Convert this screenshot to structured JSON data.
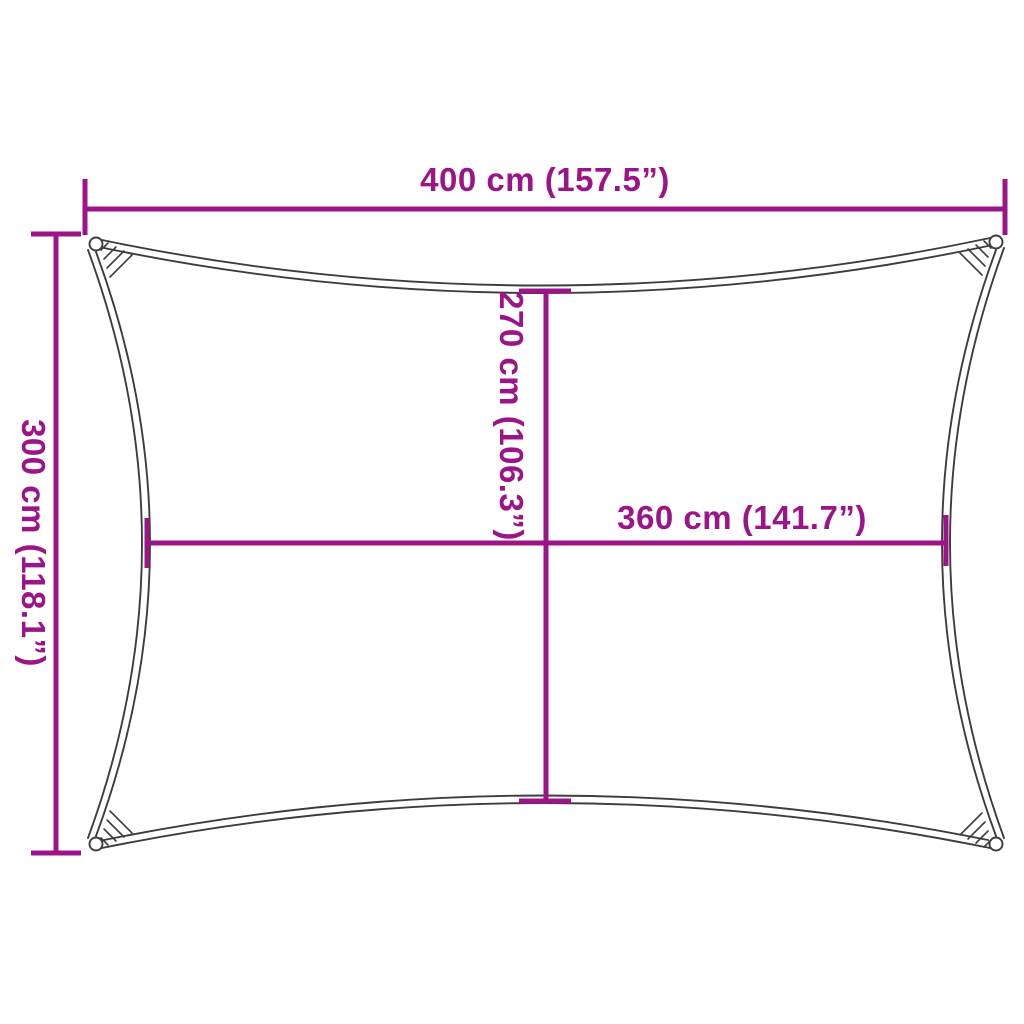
{
  "diagram": {
    "kind": "shade-sail-dimension-diagram",
    "shape": "rectangle-with-concave-edges",
    "background": "#ffffff"
  },
  "colors": {
    "dimension": "#9B1588",
    "sail_outline": "#3D3D3D"
  },
  "labels": {
    "width_top": "400 cm (157.5”)",
    "height_left": "300 cm (118.1”)",
    "height_inner": "270 cm (106.3”)",
    "width_inner": "360 cm (141.7”)"
  }
}
